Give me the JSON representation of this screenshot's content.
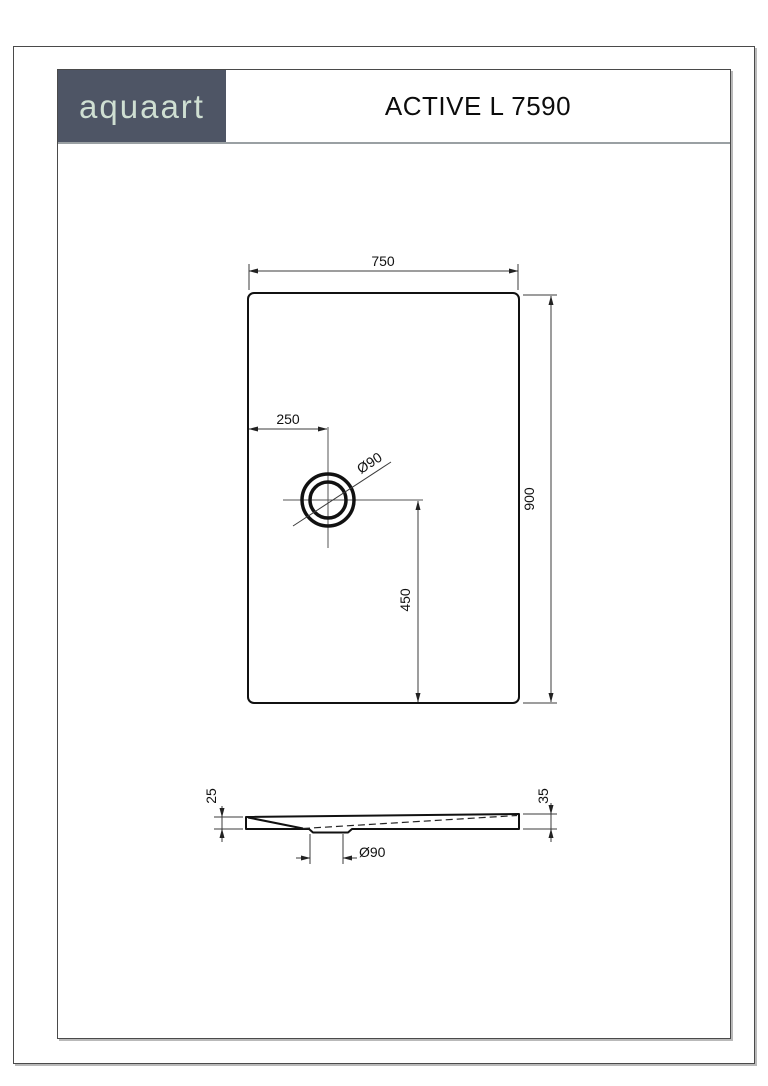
{
  "header": {
    "brand": "aquaart",
    "title": "ACTIVE L 7590"
  },
  "drawing": {
    "top_view": {
      "width_label": "750",
      "height_label": "900",
      "drain_offset_x_label": "250",
      "drain_offset_y_label": "450",
      "drain_diameter_label": "Ø90"
    },
    "side_view": {
      "left_edge_height_label": "25",
      "right_edge_height_label": "35",
      "drain_recess_width_label": "Ø90"
    }
  },
  "colors": {
    "brand_bg": "#4e5565",
    "brand_text": "#cfdfd2",
    "line": "#111111",
    "dim_line": "#3b3b3b"
  }
}
